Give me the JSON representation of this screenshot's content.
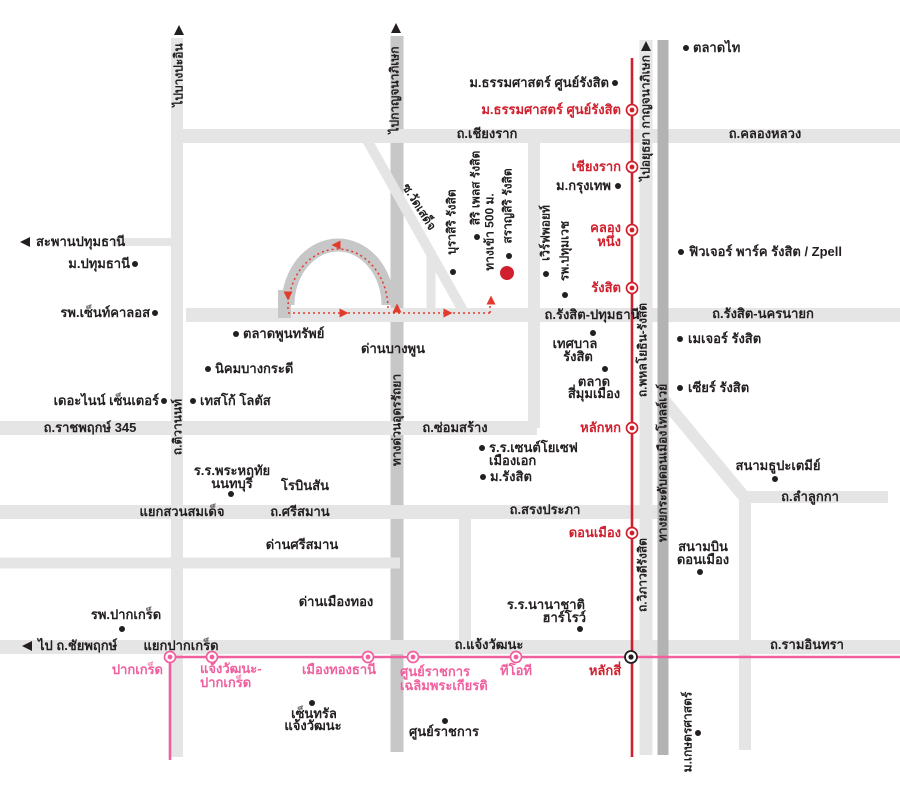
{
  "map": {
    "width": 900,
    "height": 792,
    "background": "#ffffff",
    "colors": {
      "road_light": "#e5e5e5",
      "road_mid": "#c7c7c7",
      "road_dark": "#b3b3b3",
      "rail_red": "#d0202e",
      "rail_pink": "#f0609e",
      "text_black": "#231f20",
      "text_red": "#d0202e",
      "text_pink": "#f0609e",
      "route": "#e23b2e",
      "project_marker": "#d0202e"
    },
    "roads": [
      {
        "id": "thanon-chiang-rak-khlong-luang",
        "x1": 173,
        "y1": 136,
        "x2": 905,
        "y2": 136,
        "w": 14,
        "s": "l"
      },
      {
        "id": "saphan-pathumthani-road",
        "x1": 112,
        "y1": 242,
        "x2": 183,
        "y2": 242,
        "w": 8,
        "s": "l"
      },
      {
        "id": "thanon-rangsit-pathumthani-nakhonnayok",
        "x1": 186,
        "y1": 315,
        "x2": 905,
        "y2": 315,
        "w": 14,
        "s": "l"
      },
      {
        "id": "thanon-ratchaphruek-345-somsang",
        "x1": 0,
        "y1": 428,
        "x2": 537,
        "y2": 428,
        "w": 14,
        "s": "l"
      },
      {
        "id": "thanon-srisaman-songprapha",
        "x1": 0,
        "y1": 512,
        "x2": 662,
        "y2": 512,
        "w": 14,
        "s": "l"
      },
      {
        "id": "dan-srisaman-road",
        "x1": 0,
        "y1": 563,
        "x2": 400,
        "y2": 563,
        "w": 11,
        "s": "l"
      },
      {
        "id": "thanon-chaengwattana-ramindra",
        "x1": 0,
        "y1": 647,
        "x2": 905,
        "y2": 647,
        "w": 14,
        "s": "l"
      },
      {
        "id": "thanon-lamlukka",
        "x1": 742,
        "y1": 497,
        "x2": 888,
        "y2": 497,
        "w": 12,
        "s": "l"
      },
      {
        "id": "thanon-tiwanon-vertical",
        "x1": 177,
        "y1": 38,
        "x2": 177,
        "y2": 757,
        "w": 12,
        "s": "l"
      },
      {
        "id": "vertical-road-x534",
        "x1": 534,
        "y1": 133,
        "x2": 534,
        "y2": 428,
        "w": 12,
        "s": "l"
      },
      {
        "id": "vertical-road-x465",
        "x1": 465,
        "y1": 512,
        "x2": 465,
        "y2": 647,
        "w": 12,
        "s": "l"
      },
      {
        "id": "thanon-phahonyothin-viphavadi",
        "x1": 646,
        "y1": 40,
        "x2": 646,
        "y2": 755,
        "w": 13,
        "s": "l"
      },
      {
        "id": "vertical-road-x745",
        "x1": 745,
        "y1": 497,
        "x2": 745,
        "y2": 750,
        "w": 12,
        "s": "l"
      },
      {
        "id": "soi-wat-sadet-diagonal",
        "x1": 367,
        "y1": 140,
        "x2": 466,
        "y2": 316,
        "w": 10,
        "s": "l"
      },
      {
        "id": "donmueang-diagonal",
        "x1": 664,
        "y1": 400,
        "x2": 746,
        "y2": 499,
        "w": 12,
        "s": "l"
      },
      {
        "id": "project-soi-stub",
        "x1": 431,
        "y1": 250,
        "x2": 431,
        "y2": 315,
        "w": 9,
        "s": "l"
      },
      {
        "id": "udon-ratthaya-expressway",
        "x1": 397,
        "y1": 36,
        "x2": 397,
        "y2": 752,
        "w": 13,
        "s": "m"
      },
      {
        "id": "don-mueang-tollway",
        "x1": 663,
        "y1": 40,
        "x2": 663,
        "y2": 755,
        "w": 11,
        "s": "d"
      }
    ],
    "loop": {
      "band_path": "M 288,305 A 50,60 0 1 1 388,305",
      "stub": {
        "x": 278,
        "y": 290,
        "w": 13,
        "h": 28
      }
    },
    "route": {
      "paths": [
        "M 288,309 A 50,60 0 1 1 388,309",
        "M 288,313 L 490,313",
        "M 490,313 L 490,300"
      ],
      "arrows": [
        {
          "x": 336,
          "y": 245,
          "d": "left"
        },
        {
          "x": 288,
          "y": 296,
          "d": "down"
        },
        {
          "x": 344,
          "y": 313,
          "d": "right"
        },
        {
          "x": 448,
          "y": 313,
          "d": "right"
        },
        {
          "x": 491,
          "y": 300,
          "d": "up"
        },
        {
          "x": 397,
          "y": 308,
          "d": "up"
        }
      ]
    },
    "rail_lines": [
      {
        "id": "srt-red-line",
        "x1": 632,
        "y1": 58,
        "x2": 632,
        "y2": 757,
        "color": "rail_red",
        "w": 2.6
      },
      {
        "id": "mrt-pink-line",
        "x1": 166,
        "y1": 657,
        "x2": 905,
        "y2": 657,
        "color": "rail_pink",
        "w": 2.6
      },
      {
        "id": "mrt-pink-line-branch",
        "x1": 170,
        "y1": 657,
        "x2": 170,
        "y2": 760,
        "color": "rail_pink",
        "w": 2.6
      }
    ],
    "stations_red": [
      {
        "name": "ม.ธรรมศาสตร์ ศูนย์รังสิต",
        "x": 632,
        "y": 110
      },
      {
        "name": "เชียงราก",
        "x": 632,
        "y": 167
      },
      {
        "name": "คลองหนึ่ง",
        "x": 632,
        "y": 230
      },
      {
        "name": "รังสิต",
        "x": 632,
        "y": 288
      },
      {
        "name": "หลักหก",
        "x": 632,
        "y": 428
      },
      {
        "name": "ดอนเมือง",
        "x": 632,
        "y": 533
      }
    ],
    "stations_pink": [
      {
        "name": "ปากเกร็ด",
        "x": 170,
        "y": 657
      },
      {
        "name": "แจ้งวัฒนะ-ปากเกร็ด",
        "x": 212,
        "y": 657
      },
      {
        "name": "เมืองทองธานี",
        "x": 368,
        "y": 657
      },
      {
        "name": "ศูนย์ราชการเฉลิมพระเกียรติ",
        "x": 413,
        "y": 657
      },
      {
        "name": "ทีโอที",
        "x": 516,
        "y": 657
      }
    ],
    "interchange": {
      "name": "หลักสี่",
      "x": 631,
      "y": 657
    },
    "project_marker": {
      "name": "สราญสิริ รังสิต",
      "x": 507,
      "y": 273,
      "r": 7
    },
    "poi_dots": [
      {
        "for": "ม.ธรรมศาสตร์ ศูนย์รังสิต",
        "x": 615,
        "y": 83
      },
      {
        "for": "ตลาดไท",
        "x": 686,
        "y": 48
      },
      {
        "for": "ม.กรุงเทพ",
        "x": 618,
        "y": 186
      },
      {
        "for": "ฟิวเจอร์ พาร์ค รังสิต / Zpell",
        "x": 681,
        "y": 252
      },
      {
        "for": "เมเจอร์ รังสิต",
        "x": 680,
        "y": 339
      },
      {
        "for": "เซียร์ รังสิต",
        "x": 680,
        "y": 388
      },
      {
        "for": "ม.ปทุมธานี",
        "x": 135,
        "y": 264
      },
      {
        "for": "รพ.เซ็นท์คาลอส",
        "x": 155,
        "y": 313
      },
      {
        "for": "ตลาดพูนทรัพย์",
        "x": 236,
        "y": 334
      },
      {
        "for": "นิคมบางกระดี",
        "x": 208,
        "y": 369
      },
      {
        "for": "เดอะไนน์ เซ็นเตอร์",
        "x": 164,
        "y": 401
      },
      {
        "for": "เทสโก้ โลตัส",
        "x": 193,
        "y": 401
      },
      {
        "for": "ร.ร.พระหฤทัย นนทบุรี",
        "x": 231,
        "y": 494
      },
      {
        "for": "เทศบาลรังสิต",
        "x": 593,
        "y": 333
      },
      {
        "for": "ตลาดสี่มุมเมือง",
        "x": 605,
        "y": 369
      },
      {
        "for": "ร.ร.เซนต์โยเซฟ เมืองเอก",
        "x": 482,
        "y": 448
      },
      {
        "for": "ม.รังสิต",
        "x": 483,
        "y": 477
      },
      {
        "for": "สนามธูปะเตมีย์",
        "x": 775,
        "y": 479
      },
      {
        "for": "สนามบินดอนเมือง",
        "x": 700,
        "y": 572
      },
      {
        "for": "รพ.ปากเกร็ด",
        "x": 122,
        "y": 629
      },
      {
        "for": "ร.ร.นานาชาติ ฮาร์โรว์",
        "x": 580,
        "y": 629
      },
      {
        "for": "เซ็นทรัลแจ้งวัฒนะ",
        "x": 312,
        "y": 703
      },
      {
        "for": "ศูนย์ราชการ",
        "x": 445,
        "y": 721
      },
      {
        "for": "ม.เกษตรศาสตร์",
        "x": 698,
        "y": 733
      },
      {
        "for": "บุราสิริ รังสิต",
        "x": 453,
        "y": 272
      },
      {
        "for": "สิริ เพลส รังสิต",
        "x": 477,
        "y": 237
      },
      {
        "for": "สราญสิริ รังสิต",
        "x": 509,
        "y": 256
      },
      {
        "for": "เวิร์ฟพอยท์",
        "x": 546,
        "y": 274
      },
      {
        "for": "รพ.ปทุมเวช",
        "x": 565,
        "y": 295
      }
    ],
    "road_arrows": [
      {
        "x": 179,
        "y": 30,
        "d": "up"
      },
      {
        "x": 396,
        "y": 28,
        "d": "up"
      },
      {
        "x": 646,
        "y": 46,
        "d": "up"
      },
      {
        "x": 25,
        "y": 242,
        "d": "left"
      },
      {
        "x": 27,
        "y": 646,
        "d": "left"
      }
    ],
    "labels": [
      {
        "t": "ม.ธรรมศาสตร์ ศูนย์รังสิต",
        "x": 609,
        "y": 83,
        "a": "r"
      },
      {
        "t": "ม.ธรรมศาสตร์ ศูนย์รังสิต",
        "x": 621,
        "y": 110,
        "a": "r",
        "c": "red"
      },
      {
        "t": "ตลาดไท",
        "x": 693,
        "y": 48,
        "a": "l"
      },
      {
        "t": "ถ.เชียงราก",
        "x": 487,
        "y": 134
      },
      {
        "t": "ถ.คลองหลวง",
        "x": 765,
        "y": 134
      },
      {
        "t": "เชียงราก",
        "x": 621,
        "y": 167,
        "a": "r",
        "c": "red"
      },
      {
        "t": "ม.กรุงเทพ",
        "x": 611,
        "y": 186,
        "a": "r"
      },
      {
        "t": "คลอง",
        "x": 621,
        "y": 228,
        "a": "r",
        "c": "red"
      },
      {
        "t": "หนึ่ง",
        "x": 621,
        "y": 242,
        "a": "r",
        "c": "red"
      },
      {
        "t": "รังสิต",
        "x": 621,
        "y": 288,
        "a": "r",
        "c": "red"
      },
      {
        "t": "ฟิวเจอร์ พาร์ค รังสิต / Zpell",
        "x": 689,
        "y": 252,
        "a": "l"
      },
      {
        "t": "สะพานปทุมธานี",
        "x": 36,
        "y": 242,
        "a": "l"
      },
      {
        "t": "ม.ปทุมธานี",
        "x": 130,
        "y": 264,
        "a": "r"
      },
      {
        "t": "รพ.เซ็นท์คาลอส",
        "x": 150,
        "y": 313,
        "a": "r"
      },
      {
        "t": "ถ.รังสิต-ปทุมธานี",
        "x": 592,
        "y": 315
      },
      {
        "t": "ถ.รังสิต-นครนายก",
        "x": 763,
        "y": 314
      },
      {
        "t": "เมเจอร์ รังสิต",
        "x": 688,
        "y": 339,
        "a": "l"
      },
      {
        "t": "เซียร์ รังสิต",
        "x": 688,
        "y": 388,
        "a": "l"
      },
      {
        "t": "ตลาดพูนทรัพย์",
        "x": 243,
        "y": 334,
        "a": "l"
      },
      {
        "t": "นิคมบางกระดี",
        "x": 215,
        "y": 369,
        "a": "l"
      },
      {
        "t": "ด่านบางพูน",
        "x": 393,
        "y": 349
      },
      {
        "t": "เทศบาล",
        "x": 575,
        "y": 344
      },
      {
        "t": "รังสิต",
        "x": 578,
        "y": 357
      },
      {
        "t": "ตลาด",
        "x": 594,
        "y": 382
      },
      {
        "t": "สี่มุมเมือง",
        "x": 594,
        "y": 394
      },
      {
        "t": "เดอะไนน์ เซ็นเตอร์",
        "x": 159,
        "y": 401,
        "a": "r"
      },
      {
        "t": "เทสโก้ โลตัส",
        "x": 200,
        "y": 401,
        "a": "l"
      },
      {
        "t": "ถ.ราชพฤกษ์ 345",
        "x": 90,
        "y": 428
      },
      {
        "t": "ถ.ซ่อมสร้าง",
        "x": 455,
        "y": 428
      },
      {
        "t": "หลักหก",
        "x": 621,
        "y": 428,
        "a": "r",
        "c": "red"
      },
      {
        "t": "ร.ร.เซนต์โยเซฟ",
        "x": 489,
        "y": 448,
        "a": "l"
      },
      {
        "t": "เมืองเอก",
        "x": 489,
        "y": 461,
        "a": "l"
      },
      {
        "t": "ม.รังสิต",
        "x": 490,
        "y": 477,
        "a": "l"
      },
      {
        "t": "ร.ร.พระหฤทัย",
        "x": 232,
        "y": 471
      },
      {
        "t": "นนทบุรี",
        "x": 232,
        "y": 484
      },
      {
        "t": "โรบินสัน",
        "x": 305,
        "y": 486
      },
      {
        "t": "แยกสวนสมเด็จ",
        "x": 182,
        "y": 512
      },
      {
        "t": "ถ.ศรีสมาน",
        "x": 300,
        "y": 512
      },
      {
        "t": "ถ.สรงประภา",
        "x": 545,
        "y": 510
      },
      {
        "t": "ด่านศรีสมาน",
        "x": 302,
        "y": 545
      },
      {
        "t": "ดอนเมือง",
        "x": 621,
        "y": 533,
        "a": "r",
        "c": "red"
      },
      {
        "t": "สนามธูปะเตมีย์",
        "x": 778,
        "y": 466
      },
      {
        "t": "ถ.ลำลูกกา",
        "x": 810,
        "y": 497
      },
      {
        "t": "สนามบิน",
        "x": 703,
        "y": 547
      },
      {
        "t": "ดอนเมือง",
        "x": 703,
        "y": 560
      },
      {
        "t": "ด่านเมืองทอง",
        "x": 336,
        "y": 602
      },
      {
        "t": "รพ.ปากเกร็ด",
        "x": 126,
        "y": 615
      },
      {
        "t": "ร.ร.นานาชาติ",
        "x": 585,
        "y": 605,
        "a": "r"
      },
      {
        "t": "ฮาร์โรว์",
        "x": 586,
        "y": 618,
        "a": "r"
      },
      {
        "t": "ไป ถ.ชัยพฤกษ์",
        "x": 38,
        "y": 646,
        "a": "l"
      },
      {
        "t": "แยกปากเกร็ด",
        "x": 181,
        "y": 646
      },
      {
        "t": "ถ.แจ้งวัฒนะ",
        "x": 489,
        "y": 645
      },
      {
        "t": "ถ.รามอินทรา",
        "x": 807,
        "y": 645
      },
      {
        "t": "ปากเกร็ด",
        "x": 163,
        "y": 670,
        "a": "r",
        "c": "pink"
      },
      {
        "t": "แจ้งวัฒนะ-",
        "x": 200,
        "y": 669,
        "a": "l",
        "c": "pink"
      },
      {
        "t": "ปากเกร็ด",
        "x": 200,
        "y": 683,
        "a": "l",
        "c": "pink"
      },
      {
        "t": "เมืองทองธานี",
        "x": 339,
        "y": 670,
        "c": "pink"
      },
      {
        "t": "ศูนย์ราชการ",
        "x": 400,
        "y": 672,
        "a": "l",
        "c": "pink"
      },
      {
        "t": "เฉลิมพระเกียรติ",
        "x": 400,
        "y": 686,
        "a": "l",
        "c": "pink"
      },
      {
        "t": "ทีโอที",
        "x": 516,
        "y": 671,
        "c": "pink"
      },
      {
        "t": "หลักสี่",
        "x": 605,
        "y": 671,
        "c": "red"
      },
      {
        "t": "เซ็นทรัล",
        "x": 314,
        "y": 714
      },
      {
        "t": "แจ้งวัฒนะ",
        "x": 313,
        "y": 726
      },
      {
        "t": "ศูนย์ราชการ",
        "x": 444,
        "y": 732
      },
      {
        "t": "ไปบางปะอิน",
        "x": 179,
        "y": 75,
        "r": -90,
        "fs": 12
      },
      {
        "t": "ไปกาญจนาภิเษก",
        "x": 395,
        "y": 90,
        "r": -90,
        "fs": 12
      },
      {
        "t": "ไปอยุธยา กาญจนาภิเษก",
        "x": 646,
        "y": 118,
        "r": -90,
        "fs": 12
      },
      {
        "t": "ถ.พหลโยธิน-รังสิต",
        "x": 643,
        "y": 350,
        "r": -90,
        "fs": 12
      },
      {
        "t": "ทางยกระดับดอนเมืองโทลล์เวย์",
        "x": 663,
        "y": 463,
        "r": -90,
        "fs": 12
      },
      {
        "t": "ถ.วิภาวดีรังสิต",
        "x": 643,
        "y": 575,
        "r": -90,
        "fs": 12
      },
      {
        "t": "ถ.ติวานนท์",
        "x": 178,
        "y": 427,
        "r": -90,
        "fs": 12
      },
      {
        "t": "ทางด่วนอุดรรัถยา",
        "x": 397,
        "y": 420,
        "r": -90,
        "fs": 12
      },
      {
        "t": "ม.เกษตรศาสตร์",
        "x": 688,
        "y": 732,
        "r": -90,
        "fs": 12
      },
      {
        "t": "บุราสิริ รังสิต",
        "x": 452,
        "y": 222,
        "r": -90,
        "fs": 12
      },
      {
        "t": "สิริ เพลส รังสิต",
        "x": 476,
        "y": 188,
        "r": -90,
        "fs": 12
      },
      {
        "t": "ทางเข้า 500 ม.",
        "x": 490,
        "y": 232,
        "r": -90,
        "fs": 12
      },
      {
        "t": "สราญสิริ รังสิต",
        "x": 508,
        "y": 206,
        "r": -90,
        "fs": 12
      },
      {
        "t": "เวิร์ฟพอยท์",
        "x": 546,
        "y": 233,
        "r": -90,
        "fs": 12
      },
      {
        "t": "รพ.ปทุมเวช",
        "x": 565,
        "y": 251,
        "r": -90,
        "fs": 12
      },
      {
        "t": "ซ.วัดเสด็จ",
        "x": 419,
        "y": 207,
        "r": 58,
        "fs": 12
      }
    ]
  }
}
